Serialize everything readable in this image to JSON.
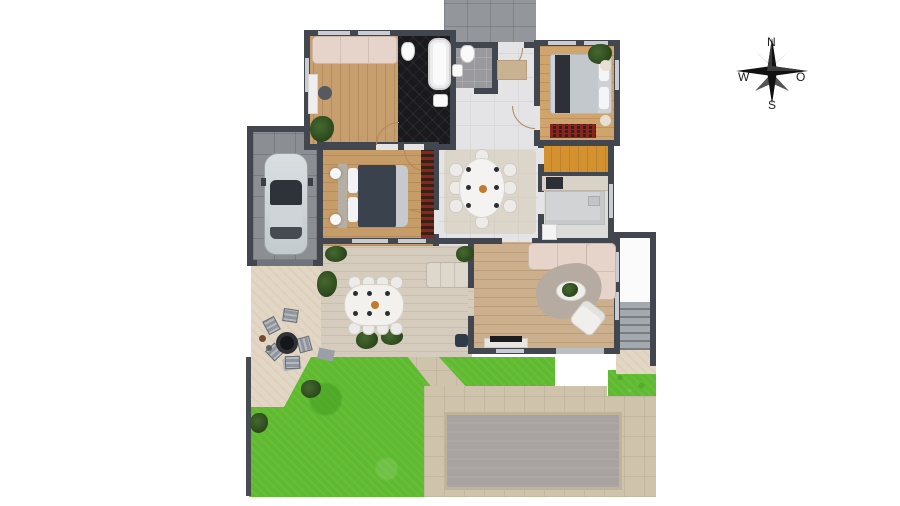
{
  "title": "house-ground-floor-plan",
  "compass": {
    "n": "N",
    "w": "W",
    "e": "O",
    "s": "S"
  },
  "colors": {
    "wall": "#42464e",
    "wood_office": "#c79e6d",
    "wood_bedroom_right": "#cfa46d",
    "wood_bedroom_master": "#c69c69",
    "wood_living": "#ccb08d",
    "tile_hall": "#e4e4e6",
    "tile_black_bath": "#1a1a1e",
    "tile_wc": "#9a9a9e",
    "garage": "#8b8f94",
    "driveway": "#93969a",
    "closet": "#d3922f",
    "kitchen_floor": "#dcddd9",
    "patio": "#e2d6c4",
    "deck": "#d6ccbd",
    "grass": "#5fba30",
    "pool_deck": "#cfc3ab",
    "pool": "#a8a2a1",
    "sofa": "#e6d3c9",
    "bed_dark": "#39424d",
    "wine_shelf": "#8a2420",
    "plant": "#2f4a22"
  },
  "rooms": [
    {
      "name": "garage",
      "floor": "gray-tile",
      "furniture": [
        "car"
      ]
    },
    {
      "name": "office",
      "floor": "wood",
      "furniture": [
        "sofa",
        "desk",
        "desk-chair",
        "plant"
      ]
    },
    {
      "name": "main-bathroom",
      "floor": "black-tile",
      "furniture": [
        "bathtub",
        "toilet",
        "sink"
      ]
    },
    {
      "name": "wc",
      "floor": "gray-tile",
      "furniture": [
        "toilet",
        "sink"
      ]
    },
    {
      "name": "entry-hall",
      "floor": "light-tile",
      "furniture": [
        "doormat"
      ]
    },
    {
      "name": "bedroom-east",
      "floor": "wood",
      "furniture": [
        "double-bed",
        "plant",
        "poufs",
        "wine-dresser"
      ]
    },
    {
      "name": "bedroom-master",
      "floor": "wood",
      "furniture": [
        "double-bed",
        "nightstand-lamps"
      ]
    },
    {
      "name": "dining-hall",
      "floor": "light-tile",
      "furniture": [
        "oval-dining-table",
        "eight-chairs",
        "rug",
        "wine-shelf"
      ]
    },
    {
      "name": "walk-in-closet",
      "floor": "orange-wood",
      "furniture": []
    },
    {
      "name": "kitchen",
      "floor": "light-tile",
      "furniture": [
        "counter",
        "stove",
        "island",
        "fridge"
      ]
    },
    {
      "name": "living-room",
      "floor": "wood",
      "furniture": [
        "l-sofa",
        "rug",
        "coffee-table",
        "plant",
        "armchair",
        "tv"
      ]
    },
    {
      "name": "side-porch",
      "floor": "white",
      "furniture": [
        "exterior-stairs"
      ]
    }
  ],
  "outdoor": {
    "areas": [
      "driveway",
      "patio",
      "wood-deck",
      "garden-grass",
      "pool-deck",
      "covered-pool",
      "paths"
    ],
    "furniture": [
      "outdoor-dining-table",
      "outdoor-chairs",
      "outdoor-sofa",
      "fire-pit",
      "lounge-chairs",
      "grill",
      "bushes",
      "stepping-stone",
      "bench"
    ]
  }
}
